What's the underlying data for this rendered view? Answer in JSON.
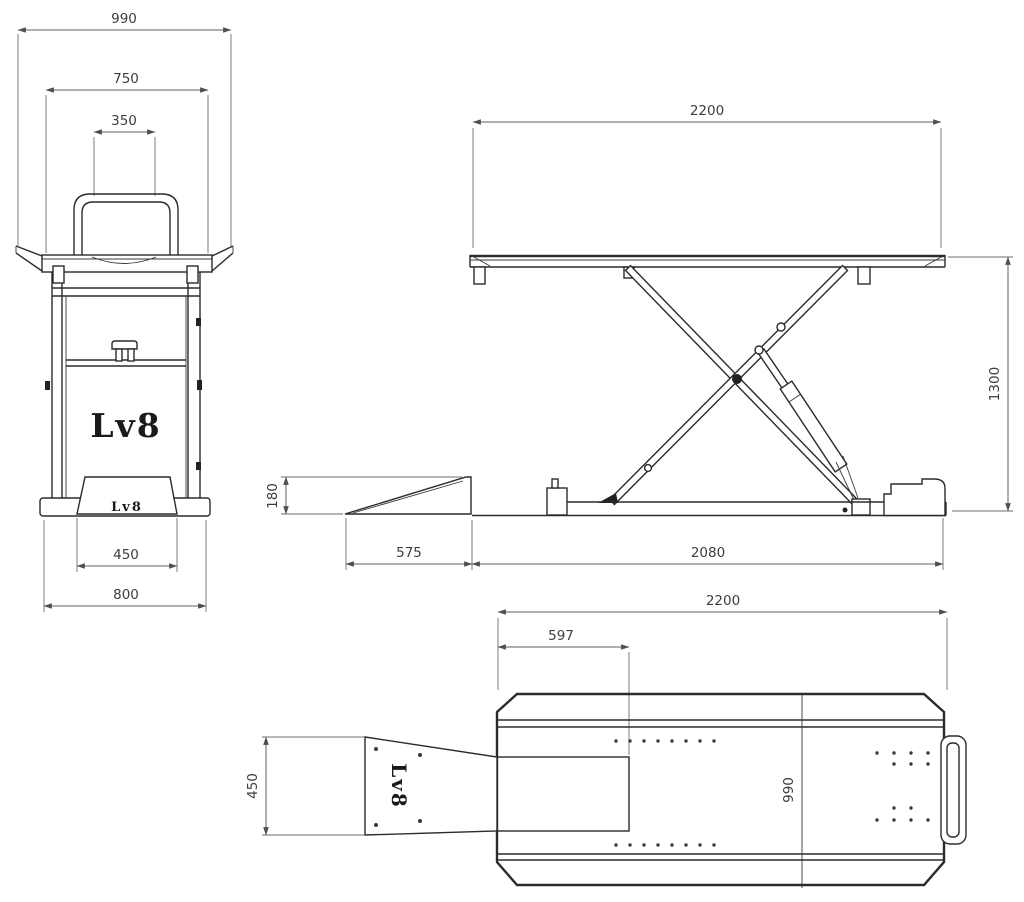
{
  "drawing": {
    "brand": {
      "logo_front": "Lv8",
      "logo_front_ramp": "Lv8",
      "logo_top_ramp": "Lv8"
    },
    "front_view": {
      "overall_width": "990",
      "platform_width": "750",
      "handle_width": "350",
      "ramp_width": "450",
      "base_width": "800"
    },
    "side_view": {
      "platform_length": "2200",
      "lift_height": "1300",
      "ramp_height": "180",
      "ramp_length": "575",
      "base_length": "2080"
    },
    "top_view": {
      "platform_length": "2200",
      "slot_offset": "597",
      "ramp_width": "450",
      "platform_width": "990"
    }
  }
}
